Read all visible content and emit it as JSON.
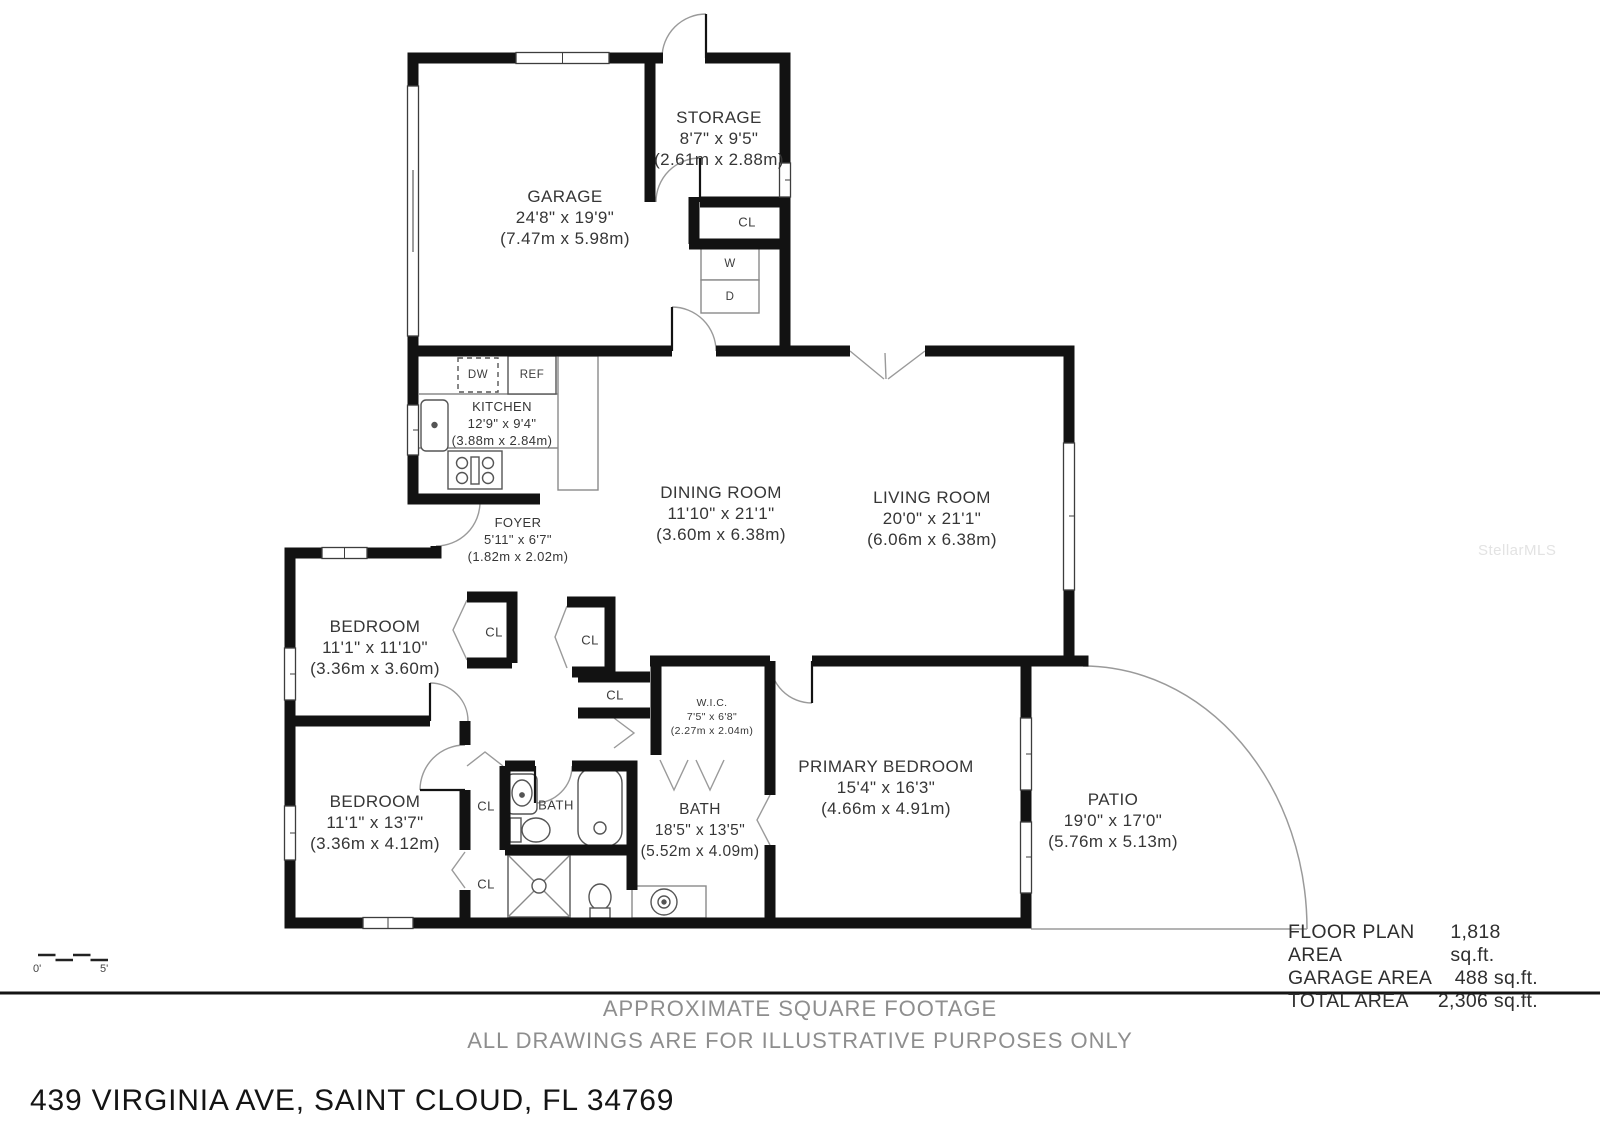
{
  "address": "439 VIRGINIA AVE, SAINT CLOUD, FL 34769",
  "watermark": "StellarMLS",
  "disclaimer": {
    "line1": "APPROXIMATE SQUARE FOOTAGE",
    "line2": "ALL DRAWINGS ARE FOR ILLUSTRATIVE PURPOSES ONLY"
  },
  "area_summary": {
    "rows": [
      {
        "label": "FLOOR PLAN AREA",
        "value": "1,818 sq.ft."
      },
      {
        "label": "GARAGE AREA",
        "value": "488 sq.ft."
      },
      {
        "label": "TOTAL AREA",
        "value": "2,306 sq.ft."
      }
    ]
  },
  "scale_bar": {
    "start": "0'",
    "end": "5'"
  },
  "rooms": {
    "storage": {
      "name": "STORAGE",
      "imperial": "8'7\" x 9'5\"",
      "metric": "(2.61m x 2.88m)"
    },
    "garage": {
      "name": "GARAGE",
      "imperial": "24'8\" x 19'9\"",
      "metric": "(7.47m x 5.98m)"
    },
    "kitchen": {
      "name": "KITCHEN",
      "imperial": "12'9\" x 9'4\"",
      "metric": "(3.88m x 2.84m)"
    },
    "dining": {
      "name": "DINING ROOM",
      "imperial": "11'10\" x 21'1\"",
      "metric": "(3.60m x 6.38m)"
    },
    "living": {
      "name": "LIVING ROOM",
      "imperial": "20'0\" x 21'1\"",
      "metric": "(6.06m x 6.38m)"
    },
    "foyer": {
      "name": "FOYER",
      "imperial": "5'11\" x 6'7\"",
      "metric": "(1.82m x 2.02m)"
    },
    "bedroom1": {
      "name": "BEDROOM",
      "imperial": "11'1\" x 11'10\"",
      "metric": "(3.36m x 3.60m)"
    },
    "bedroom2": {
      "name": "BEDROOM",
      "imperial": "11'1\" x 13'7\"",
      "metric": "(3.36m x 4.12m)"
    },
    "wic": {
      "name": "W.I.C.",
      "imperial": "7'5\" x 6'8\"",
      "metric": "(2.27m x 2.04m)"
    },
    "bath": {
      "name": "BATH",
      "imperial": "18'5\" x 13'5\"",
      "metric": "(5.52m x 4.09m)"
    },
    "primary": {
      "name": "PRIMARY BEDROOM",
      "imperial": "15'4\" x 16'3\"",
      "metric": "(4.66m x 4.91m)"
    },
    "patio": {
      "name": "PATIO",
      "imperial": "19'0\" x 17'0\"",
      "metric": "(5.76m x 5.13m)"
    }
  },
  "fixtures": {
    "closet": "CL",
    "dishwasher": "DW",
    "refrigerator": "REF",
    "washer": "W",
    "dryer": "D",
    "bath_small": "BATH"
  }
}
